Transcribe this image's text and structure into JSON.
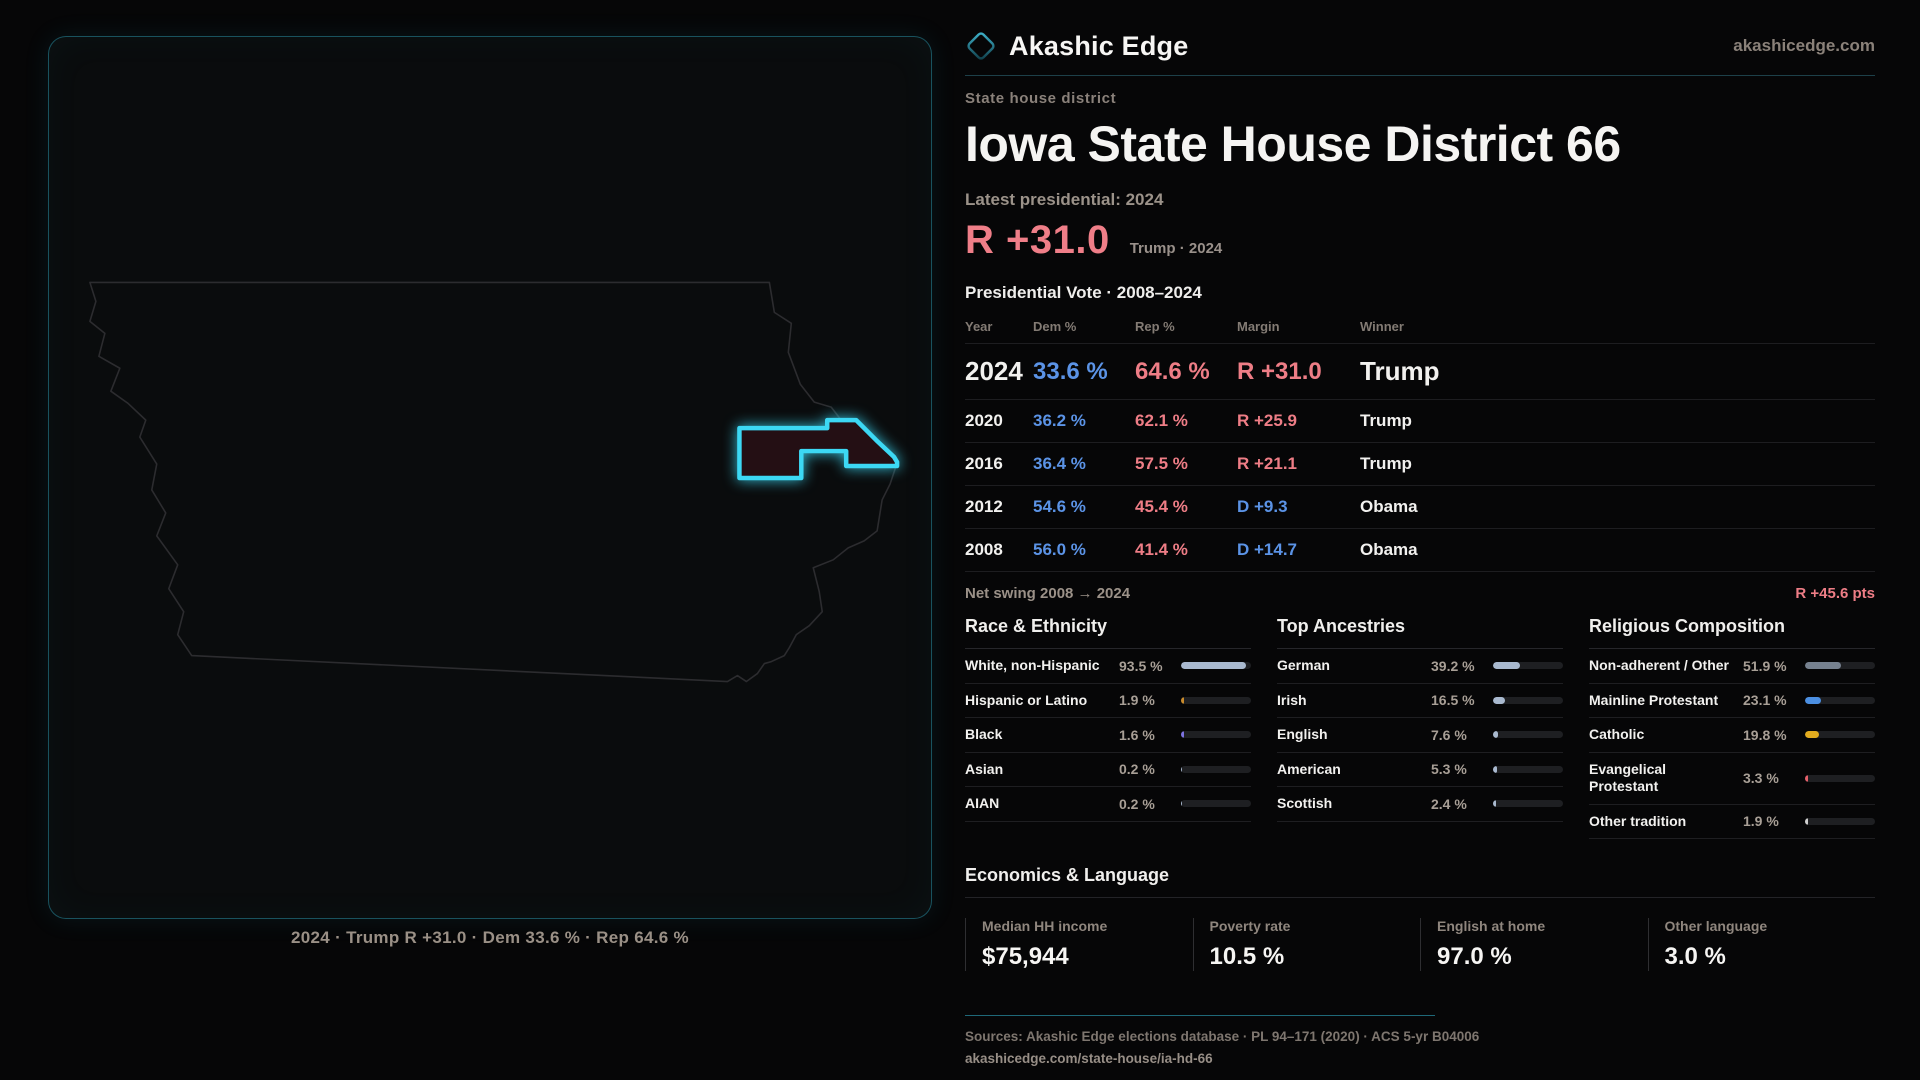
{
  "brand": {
    "name": "Akashic Edge",
    "domain": "akashicedge.com"
  },
  "page": {
    "kicker": "State house district",
    "title": "Iowa State House District 66",
    "latest_label": "Latest presidential: 2024",
    "headline_margin": "R +31.0",
    "headline_context": "Trump · 2024"
  },
  "map": {
    "state": "Iowa",
    "caption": "2024 · Trump R +31.0 · Dem 33.6 % · Rep 64.6 %"
  },
  "results": {
    "section_title": "Presidential Vote · 2008–2024",
    "columns": [
      "Year",
      "Dem %",
      "Rep %",
      "Margin",
      "Winner"
    ],
    "rows": [
      {
        "year": "2024",
        "dem": "33.6 %",
        "rep": "64.6 %",
        "margin": "R +31.0",
        "margin_party": "R",
        "winner": "Trump",
        "highlight": true
      },
      {
        "year": "2020",
        "dem": "36.2 %",
        "rep": "62.1 %",
        "margin": "R +25.9",
        "margin_party": "R",
        "winner": "Trump",
        "highlight": false
      },
      {
        "year": "2016",
        "dem": "36.4 %",
        "rep": "57.5 %",
        "margin": "R +21.1",
        "margin_party": "R",
        "winner": "Trump",
        "highlight": false
      },
      {
        "year": "2012",
        "dem": "54.6 %",
        "rep": "45.4 %",
        "margin": "D +9.3",
        "margin_party": "D",
        "winner": "Obama",
        "highlight": false
      },
      {
        "year": "2008",
        "dem": "56.0 %",
        "rep": "41.4 %",
        "margin": "D +14.7",
        "margin_party": "D",
        "winner": "Obama",
        "highlight": false
      }
    ],
    "net_swing_label": "Net swing 2008 → 2024",
    "net_swing_value": "R +45.6 pts"
  },
  "demographics": {
    "panels": [
      {
        "title": "Race & Ethnicity",
        "rows": [
          {
            "label": "White, non-Hispanic",
            "value": "93.5 %",
            "pct": 93.5,
            "color": "#a9b9cf"
          },
          {
            "label": "Hispanic or Latino",
            "value": "1.9 %",
            "pct": 1.9,
            "color": "#c98b2d"
          },
          {
            "label": "Black",
            "value": "1.6 %",
            "pct": 1.6,
            "color": "#7d72e0"
          },
          {
            "label": "Asian",
            "value": "0.2 %",
            "pct": 0.2,
            "color": "#a9b9cf"
          },
          {
            "label": "AIAN",
            "value": "0.2 %",
            "pct": 0.2,
            "color": "#a9b9cf"
          }
        ]
      },
      {
        "title": "Top Ancestries",
        "rows": [
          {
            "label": "German",
            "value": "39.2 %",
            "pct": 39.2,
            "color": "#a9b9cf"
          },
          {
            "label": "Irish",
            "value": "16.5 %",
            "pct": 16.5,
            "color": "#a9b9cf"
          },
          {
            "label": "English",
            "value": "7.6 %",
            "pct": 7.6,
            "color": "#a9b9cf"
          },
          {
            "label": "American",
            "value": "5.3 %",
            "pct": 5.3,
            "color": "#a9b9cf"
          },
          {
            "label": "Scottish",
            "value": "2.4 %",
            "pct": 2.4,
            "color": "#a9b9cf"
          }
        ]
      },
      {
        "title": "Religious Composition",
        "rows": [
          {
            "label": "Non-adherent / Other",
            "value": "51.9 %",
            "pct": 51.9,
            "color": "#76818f"
          },
          {
            "label": "Mainline Protestant",
            "value": "23.1 %",
            "pct": 23.1,
            "color": "#4b8fe2"
          },
          {
            "label": "Catholic",
            "value": "19.8 %",
            "pct": 19.8,
            "color": "#e2ab1e"
          },
          {
            "label": "Evangelical Protestant",
            "value": "3.3 %",
            "pct": 3.3,
            "color": "#e4606a"
          },
          {
            "label": "Other tradition",
            "value": "1.9 %",
            "pct": 1.9,
            "color": "#cfcfcf"
          }
        ]
      }
    ]
  },
  "economics": {
    "title": "Economics & Language",
    "stats": [
      {
        "label": "Median HH income",
        "value": "$75,944"
      },
      {
        "label": "Poverty rate",
        "value": "10.5 %"
      },
      {
        "label": "English at home",
        "value": "97.0 %"
      },
      {
        "label": "Other language",
        "value": "3.0 %"
      }
    ]
  },
  "footer": {
    "sources": "Sources: Akashic Edge elections database · PL 94–171 (2020) · ACS 5-yr B04006",
    "permalink": "akashicedge.com/state-house/ia-hd-66"
  },
  "colors": {
    "dem_blue": "#5b93e6",
    "rep_red": "#ee7d86",
    "accent_teal": "#2ca8c2",
    "district_glow": "#3cd8f4",
    "page_bg": "#060607"
  }
}
